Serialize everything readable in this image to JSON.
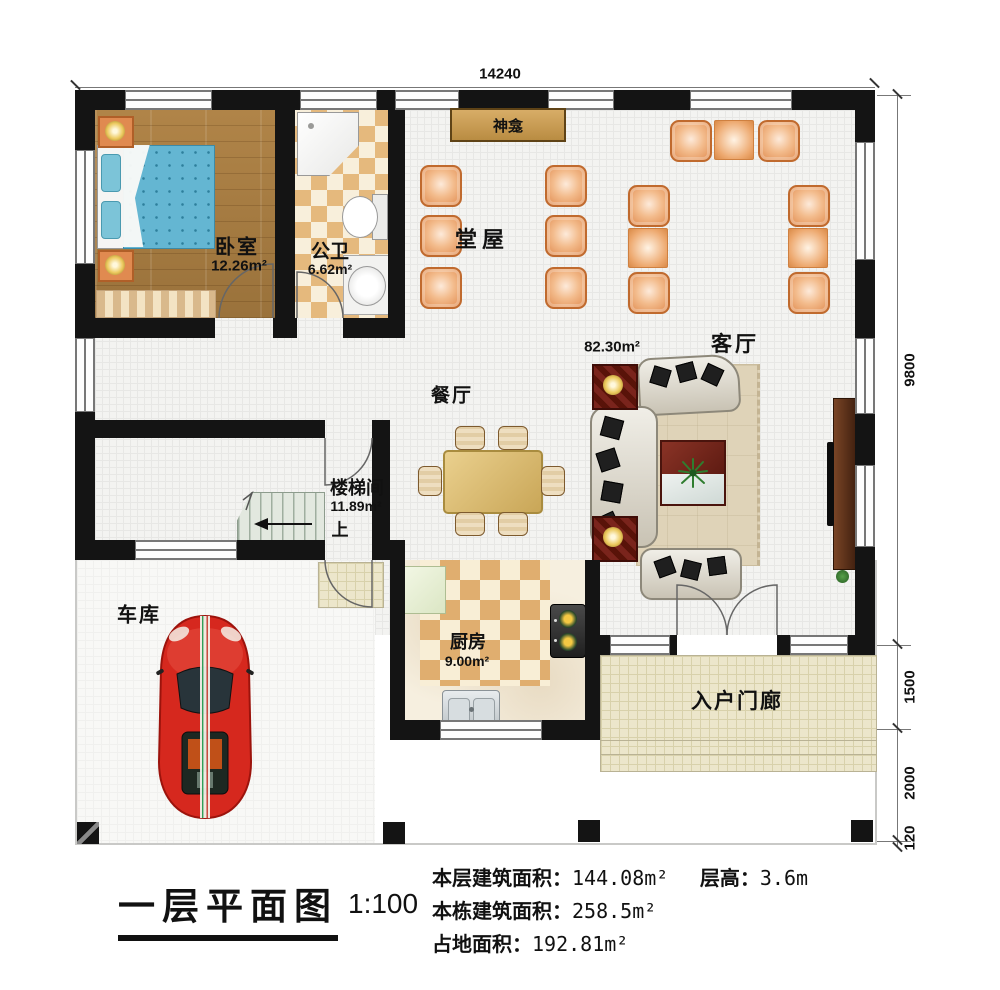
{
  "plan": {
    "dim_top": "14240",
    "dims_right": [
      "9800",
      "1500",
      "2000",
      "120"
    ],
    "rooms": {
      "bedroom": {
        "name": "卧室",
        "area": "12.26m²"
      },
      "bathroom": {
        "name": "公卫",
        "area": "6.62m²"
      },
      "hall": {
        "name": "堂屋"
      },
      "shrine": {
        "name": "神龛"
      },
      "living": {
        "name": "客厅",
        "area": "82.30m²"
      },
      "dining": {
        "name": "餐厅"
      },
      "stairwell": {
        "name": "楼梯间",
        "area": "11.89m²",
        "direction": "上"
      },
      "garage": {
        "name": "车库"
      },
      "kitchen": {
        "name": "厨房",
        "area": "9.00m²"
      },
      "porch": {
        "name": "入户门廊"
      }
    }
  },
  "title_block": {
    "title": "一层平面图",
    "scale": "1:100",
    "stats": [
      {
        "label": "本层建筑面积：",
        "value": "144.08m²"
      },
      {
        "label": "层高：",
        "value": "3.6m"
      },
      {
        "label": "本栋建筑面积：",
        "value": "258.5m²"
      },
      {
        "label": "占地面积：",
        "value": "192.81m²"
      }
    ]
  },
  "colors": {
    "wall": "#141414",
    "chair_wood": "#e08a4e",
    "shrine_wood": "#c89a54",
    "car_red": "#d6281e",
    "table_red": "#7a241c",
    "floor_checker": "#e5b97d"
  }
}
